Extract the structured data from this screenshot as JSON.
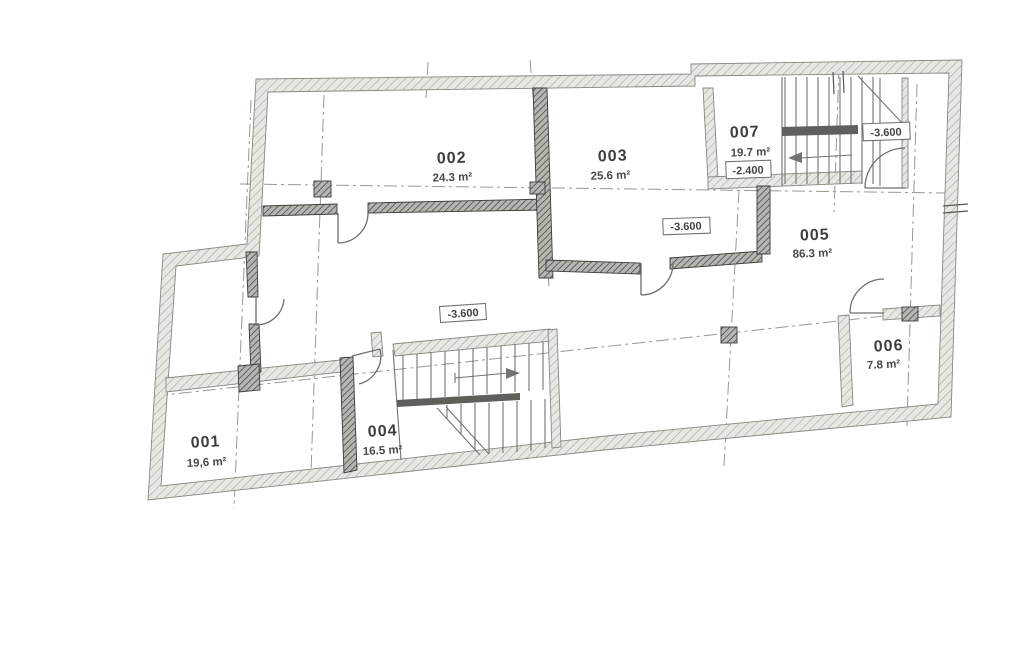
{
  "plan": {
    "title": "basement floor plan",
    "rooms": [
      {
        "id": "001",
        "area": "19,6 m²"
      },
      {
        "id": "002",
        "area": "24.3 m²"
      },
      {
        "id": "003",
        "area": "25.6 m²"
      },
      {
        "id": "004",
        "area": "16.5 m²"
      },
      {
        "id": "005",
        "area": "86.3 m²"
      },
      {
        "id": "006",
        "area": "7.8 m²"
      },
      {
        "id": "007",
        "area": "19.7 m²"
      }
    ],
    "elevations": [
      {
        "value": "-3.600",
        "location": "center-stair"
      },
      {
        "value": "-3.600",
        "location": "room-003"
      },
      {
        "value": "-2.400",
        "location": "room-007"
      },
      {
        "value": "-3.600",
        "location": "top-right-stair"
      }
    ],
    "colors": {
      "paper": "#ffffff",
      "wall_fill": "#e9e7e4",
      "wall_hatch": "#a39f9a",
      "dark_wall_fill": "#b7b5b2",
      "ink": "#403e3a"
    }
  }
}
